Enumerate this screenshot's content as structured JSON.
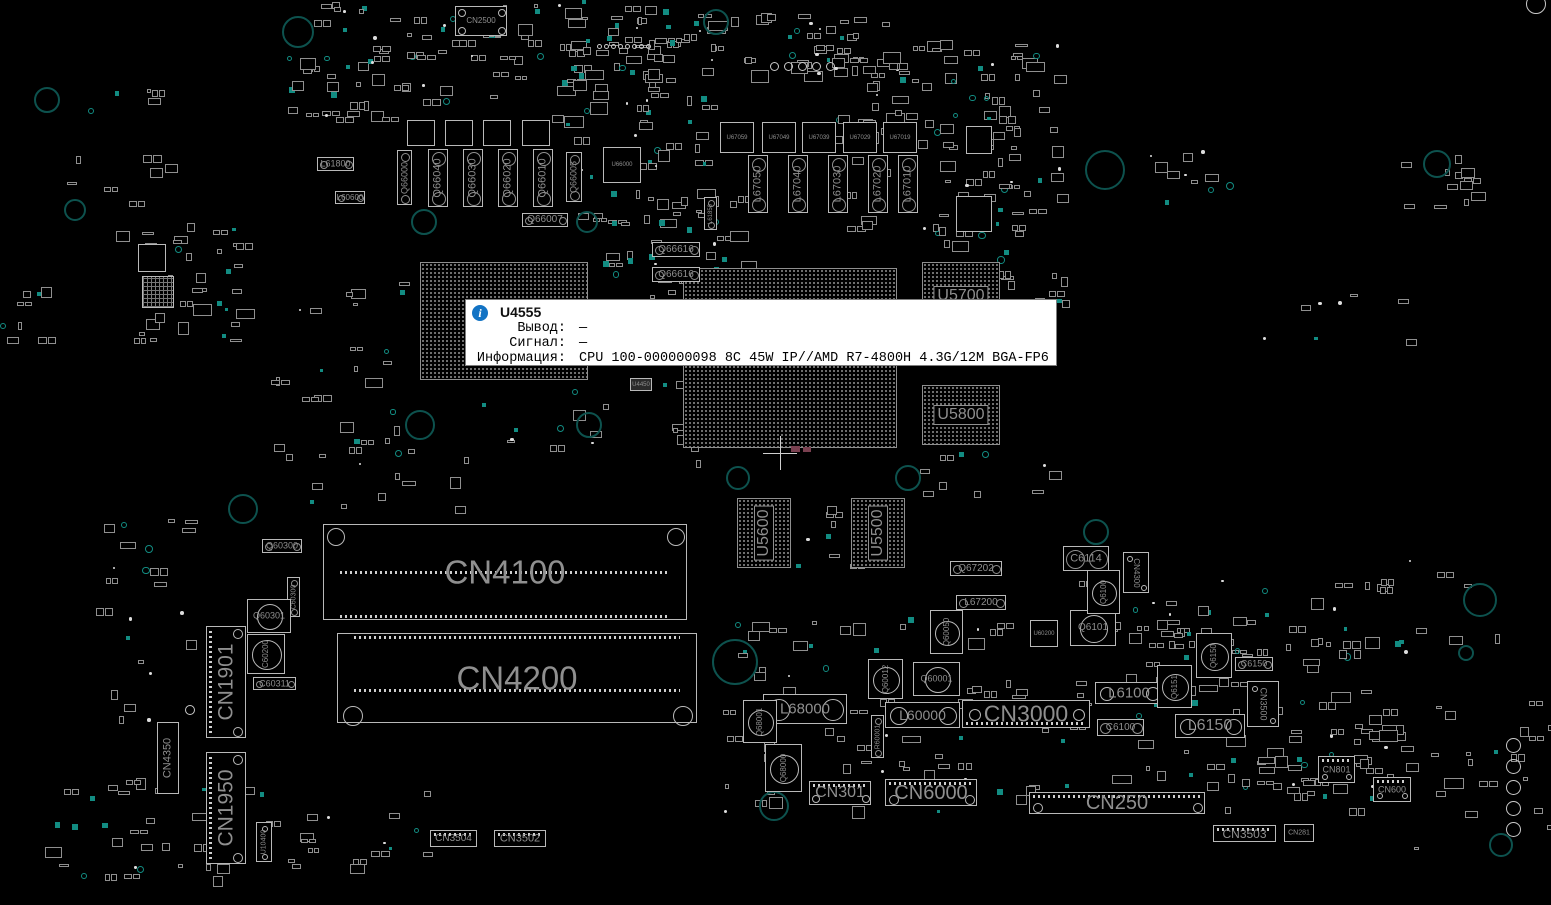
{
  "app": {
    "name": "boardview",
    "view": "top"
  },
  "colors": {
    "bg": "#000000",
    "outline": "#b9b9b9",
    "outline_dim": "#8f8f8f",
    "label": "#8f8f8f",
    "teal": "#128c82",
    "teal_ring": "#0d524e",
    "tooltip_bg": "#ffffff",
    "tooltip_text": "#000000",
    "info_blue": "#1273c4",
    "pink": "#7a4050"
  },
  "tooltip": {
    "ref": "U4555",
    "icon_glyph": "i",
    "x": 465,
    "y": 299,
    "w": 592,
    "h": 67,
    "rows": [
      {
        "label": "Вывод:",
        "value": "—"
      },
      {
        "label": "Сигнал:",
        "value": "—"
      },
      {
        "label": "Информация:",
        "value": "CPU 100-000000098 8C 45W IP//AMD R7-4800H 4.3G/12M BGA-FP6"
      }
    ]
  },
  "components": {
    "bgas": [
      {
        "ref": "",
        "x": 420,
        "y": 262,
        "w": 168,
        "h": 118,
        "fs": 0,
        "rot": 0
      },
      {
        "ref": "",
        "x": 683,
        "y": 268,
        "w": 214,
        "h": 180,
        "fs": 0,
        "rot": 0
      },
      {
        "ref": "U5700",
        "x": 922,
        "y": 262,
        "w": 78,
        "h": 68,
        "fs": 16,
        "rot": 0
      },
      {
        "ref": "U5800",
        "x": 922,
        "y": 385,
        "w": 78,
        "h": 60,
        "fs": 16,
        "rot": 0
      },
      {
        "ref": "U5600",
        "x": 737,
        "y": 498,
        "w": 54,
        "h": 70,
        "fs": 16,
        "rot": -90
      },
      {
        "ref": "U5500",
        "x": 851,
        "y": 498,
        "w": 54,
        "h": 70,
        "fs": 16,
        "rot": -90
      }
    ],
    "slots": [
      {
        "ref": "CN4100",
        "x": 323,
        "y": 524,
        "w": 364,
        "h": 96,
        "fs": 33,
        "circles": [
          [
            12,
            12,
            9
          ],
          [
            352,
            12,
            9
          ]
        ],
        "strips": [
          {
            "y": 46,
            "x0": 16,
            "x1": 348
          },
          {
            "y": 90,
            "x0": 16,
            "x1": 348
          }
        ]
      },
      {
        "ref": "CN4200",
        "x": 337,
        "y": 633,
        "w": 360,
        "h": 90,
        "fs": 33,
        "circles": [
          [
            15,
            82,
            10
          ],
          [
            345,
            82,
            10
          ]
        ],
        "strips": [
          {
            "y": 2,
            "x0": 16,
            "x1": 344
          },
          {
            "y": 55,
            "x0": 16,
            "x1": 344
          }
        ]
      }
    ],
    "hconn": [
      {
        "ref": "CN2500",
        "x": 455,
        "y": 6,
        "w": 52,
        "h": 30,
        "fs": 8,
        "pins": null,
        "circles": [
          [
            6,
            6,
            4
          ],
          [
            46,
            6,
            4
          ],
          [
            6,
            24,
            4
          ],
          [
            46,
            24,
            4
          ]
        ]
      },
      {
        "ref": "CN3000",
        "x": 962,
        "y": 700,
        "w": 128,
        "h": 28,
        "fs": 23,
        "pins": "bottom",
        "circles": [
          [
            12,
            14,
            6
          ],
          [
            116,
            14,
            6
          ]
        ]
      },
      {
        "ref": "CN6000",
        "x": 885,
        "y": 779,
        "w": 92,
        "h": 27,
        "fs": 20,
        "pins": "top",
        "circles": [
          [
            8,
            20,
            5
          ],
          [
            84,
            20,
            5
          ]
        ]
      },
      {
        "ref": "CN301",
        "x": 809,
        "y": 781,
        "w": 62,
        "h": 24,
        "fs": 16,
        "pins": "top",
        "circles": [
          [
            6,
            17,
            4
          ],
          [
            56,
            17,
            4
          ]
        ]
      },
      {
        "ref": "CN250",
        "x": 1029,
        "y": 792,
        "w": 176,
        "h": 22,
        "fs": 20,
        "pins": "top",
        "circles": [
          [
            8,
            15,
            5
          ],
          [
            168,
            15,
            5
          ]
        ]
      },
      {
        "ref": "CN3503",
        "x": 1213,
        "y": 825,
        "w": 63,
        "h": 17,
        "fs": 12,
        "pins": "top",
        "circles": []
      },
      {
        "ref": "CN281",
        "x": 1284,
        "y": 824,
        "w": 30,
        "h": 18,
        "fs": 7,
        "pins": null,
        "circles": []
      },
      {
        "ref": "CN801",
        "x": 1318,
        "y": 756,
        "w": 37,
        "h": 27,
        "fs": 9,
        "pins": "top",
        "circles": [
          [
            6,
            20,
            3
          ],
          [
            30,
            20,
            3
          ]
        ]
      },
      {
        "ref": "CN600",
        "x": 1373,
        "y": 777,
        "w": 38,
        "h": 25,
        "fs": 9,
        "pins": "top",
        "circles": [
          [
            6,
            18,
            3
          ],
          [
            31,
            18,
            3
          ]
        ]
      },
      {
        "ref": "CN3504",
        "x": 430,
        "y": 830,
        "w": 47,
        "h": 17,
        "fs": 10,
        "pins": "top",
        "circles": []
      },
      {
        "ref": "CN3502",
        "x": 494,
        "y": 830,
        "w": 52,
        "h": 17,
        "fs": 11,
        "pins": "top",
        "circles": []
      }
    ],
    "vconn": [
      {
        "ref": "CN1901",
        "x": 206,
        "y": 626,
        "w": 40,
        "h": 112,
        "fs": 21,
        "rot": -90,
        "pins": "left",
        "circles": [
          [
            31,
            7,
            5
          ],
          [
            31,
            105,
            5
          ]
        ]
      },
      {
        "ref": "CN1950",
        "x": 206,
        "y": 752,
        "w": 40,
        "h": 112,
        "fs": 21,
        "rot": -90,
        "pins": "left",
        "circles": [
          [
            31,
            7,
            5
          ],
          [
            31,
            105,
            5
          ]
        ]
      },
      {
        "ref": "CN4350",
        "x": 157,
        "y": 722,
        "w": 22,
        "h": 72,
        "fs": 11,
        "rot": -90,
        "pins": null,
        "circles": []
      },
      {
        "ref": "CN4300",
        "x": 1123,
        "y": 552,
        "w": 26,
        "h": 41,
        "fs": 8,
        "rot": 90,
        "pins": null,
        "circles": [
          [
            6,
            6,
            3
          ],
          [
            20,
            35,
            3
          ]
        ]
      },
      {
        "ref": "CN3500",
        "x": 1247,
        "y": 681,
        "w": 32,
        "h": 46,
        "fs": 9,
        "rot": 90,
        "pins": null,
        "circles": [
          [
            7,
            7,
            3
          ],
          [
            25,
            39,
            3
          ]
        ]
      },
      {
        "ref": "U10400",
        "x": 256,
        "y": 822,
        "w": 16,
        "h": 40,
        "fs": 7,
        "rot": -90,
        "pins": null,
        "circles": [
          [
            8,
            6,
            3
          ],
          [
            8,
            34,
            3
          ]
        ]
      }
    ],
    "tall": [
      {
        "ref": "Q66000",
        "x": 397,
        "y": 150,
        "w": 15,
        "h": 55,
        "fs": 9
      },
      {
        "ref": "Q66040",
        "x": 428,
        "y": 149,
        "w": 20,
        "h": 58,
        "fs": 11
      },
      {
        "ref": "Q66030",
        "x": 463,
        "y": 149,
        "w": 20,
        "h": 58,
        "fs": 11
      },
      {
        "ref": "Q66020",
        "x": 498,
        "y": 149,
        "w": 20,
        "h": 58,
        "fs": 11
      },
      {
        "ref": "Q66010",
        "x": 533,
        "y": 149,
        "w": 20,
        "h": 58,
        "fs": 11
      },
      {
        "ref": "Q66005",
        "x": 566,
        "y": 152,
        "w": 16,
        "h": 50,
        "fs": 9
      },
      {
        "ref": "L67050",
        "x": 748,
        "y": 155,
        "w": 20,
        "h": 58,
        "fs": 11
      },
      {
        "ref": "L67040",
        "x": 788,
        "y": 155,
        "w": 20,
        "h": 58,
        "fs": 11
      },
      {
        "ref": "L67030",
        "x": 828,
        "y": 155,
        "w": 20,
        "h": 58,
        "fs": 11
      },
      {
        "ref": "L67020",
        "x": 868,
        "y": 155,
        "w": 20,
        "h": 58,
        "fs": 11
      },
      {
        "ref": "L67010",
        "x": 898,
        "y": 155,
        "w": 20,
        "h": 58,
        "fs": 11
      },
      {
        "ref": "C60300",
        "x": 287,
        "y": 577,
        "w": 13,
        "h": 40,
        "fs": 7
      },
      {
        "ref": "R60001",
        "x": 871,
        "y": 715,
        "w": 13,
        "h": 43,
        "fs": 7
      },
      {
        "ref": "L61850",
        "x": 704,
        "y": 197,
        "w": 13,
        "h": 33,
        "fs": 6
      }
    ],
    "pills": [
      {
        "ref": "L61800",
        "x": 317,
        "y": 157,
        "w": 37,
        "h": 14,
        "fs": 9
      },
      {
        "ref": "L60600",
        "x": 335,
        "y": 191,
        "w": 30,
        "h": 13,
        "fs": 8
      },
      {
        "ref": "Q66007",
        "x": 522,
        "y": 213,
        "w": 46,
        "h": 14,
        "fs": 10
      },
      {
        "ref": "Q66616",
        "x": 652,
        "y": 242,
        "w": 48,
        "h": 15,
        "fs": 10
      },
      {
        "ref": "Q66616",
        "x": 652,
        "y": 267,
        "w": 48,
        "h": 15,
        "fs": 10
      },
      {
        "ref": "Q60300",
        "x": 262,
        "y": 539,
        "w": 40,
        "h": 14,
        "fs": 9
      },
      {
        "ref": "C60311",
        "x": 253,
        "y": 677,
        "w": 43,
        "h": 13,
        "fs": 9
      },
      {
        "ref": "Q67202",
        "x": 950,
        "y": 561,
        "w": 52,
        "h": 15,
        "fs": 10
      },
      {
        "ref": "L67200",
        "x": 956,
        "y": 595,
        "w": 50,
        "h": 15,
        "fs": 10
      },
      {
        "ref": "C6150",
        "x": 1235,
        "y": 657,
        "w": 38,
        "h": 14,
        "fs": 9
      },
      {
        "ref": "C6100",
        "x": 1097,
        "y": 719,
        "w": 47,
        "h": 17,
        "fs": 10
      },
      {
        "ref": "C6114",
        "x": 1063,
        "y": 546,
        "w": 46,
        "h": 25,
        "fs": 11
      }
    ],
    "chokes": [
      {
        "ref": "L68000",
        "x": 763,
        "y": 694,
        "w": 84,
        "h": 30,
        "fs": 15
      },
      {
        "ref": "L60000",
        "x": 885,
        "y": 702,
        "w": 75,
        "h": 26,
        "fs": 14
      },
      {
        "ref": "L6100",
        "x": 1095,
        "y": 682,
        "w": 68,
        "h": 22,
        "fs": 15
      },
      {
        "ref": "L6150",
        "x": 1175,
        "y": 714,
        "w": 70,
        "h": 24,
        "fs": 16
      }
    ],
    "fets": [
      {
        "ref": "Q60301",
        "x": 247,
        "y": 599,
        "w": 44,
        "h": 34,
        "fs": 9,
        "rot": 0
      },
      {
        "ref": "C60200",
        "x": 247,
        "y": 634,
        "w": 38,
        "h": 40,
        "fs": 8,
        "rot": -90
      },
      {
        "ref": "Q6101",
        "x": 1070,
        "y": 610,
        "w": 46,
        "h": 36,
        "fs": 10,
        "rot": 0
      },
      {
        "ref": "Q6100",
        "x": 1087,
        "y": 570,
        "w": 33,
        "h": 44,
        "fs": 8,
        "rot": -90
      },
      {
        "ref": "Q6150",
        "x": 1196,
        "y": 633,
        "w": 36,
        "h": 45,
        "fs": 8,
        "rot": -90
      },
      {
        "ref": "Q6151",
        "x": 1157,
        "y": 665,
        "w": 35,
        "h": 43,
        "fs": 8,
        "rot": -90
      },
      {
        "ref": "Q60050",
        "x": 930,
        "y": 610,
        "w": 33,
        "h": 44,
        "fs": 8,
        "rot": -90
      },
      {
        "ref": "Q60012",
        "x": 868,
        "y": 659,
        "w": 35,
        "h": 40,
        "fs": 8,
        "rot": -90
      },
      {
        "ref": "Q60001",
        "x": 913,
        "y": 662,
        "w": 47,
        "h": 34,
        "fs": 9,
        "rot": 0
      },
      {
        "ref": "Q68001",
        "x": 743,
        "y": 700,
        "w": 34,
        "h": 43,
        "fs": 8,
        "rot": -90
      },
      {
        "ref": "Q68000",
        "x": 765,
        "y": 744,
        "w": 37,
        "h": 48,
        "fs": 8,
        "rot": -90
      }
    ],
    "ics": [
      {
        "ref": "U66000",
        "x": 603,
        "y": 147,
        "w": 38,
        "h": 36,
        "fs": 6
      },
      {
        "ref": "U67059",
        "x": 720,
        "y": 122,
        "w": 34,
        "h": 31,
        "fs": 6
      },
      {
        "ref": "U67049",
        "x": 762,
        "y": 122,
        "w": 34,
        "h": 31,
        "fs": 6
      },
      {
        "ref": "U67039",
        "x": 802,
        "y": 122,
        "w": 34,
        "h": 31,
        "fs": 6
      },
      {
        "ref": "U67029",
        "x": 843,
        "y": 122,
        "w": 34,
        "h": 31,
        "fs": 6
      },
      {
        "ref": "U67019",
        "x": 883,
        "y": 122,
        "w": 34,
        "h": 31,
        "fs": 6
      },
      {
        "ref": "U60200",
        "x": 1030,
        "y": 620,
        "w": 28,
        "h": 27,
        "fs": 6
      },
      {
        "ref": "U4450",
        "x": 630,
        "y": 378,
        "w": 22,
        "h": 13,
        "fs": 6,
        "filled": true
      },
      {
        "ref": "",
        "x": 407,
        "y": 120,
        "w": 28,
        "h": 26,
        "fs": 6
      },
      {
        "ref": "",
        "x": 445,
        "y": 120,
        "w": 28,
        "h": 26,
        "fs": 6
      },
      {
        "ref": "",
        "x": 483,
        "y": 120,
        "w": 28,
        "h": 26,
        "fs": 6
      },
      {
        "ref": "",
        "x": 522,
        "y": 120,
        "w": 28,
        "h": 26,
        "fs": 6
      },
      {
        "ref": "",
        "x": 966,
        "y": 126,
        "w": 26,
        "h": 28,
        "fs": 6
      },
      {
        "ref": "",
        "x": 956,
        "y": 196,
        "w": 36,
        "h": 36,
        "fs": 6
      },
      {
        "ref": "",
        "x": 138,
        "y": 244,
        "w": 28,
        "h": 28,
        "fs": 6
      },
      {
        "ref": "",
        "x": 142,
        "y": 276,
        "w": 32,
        "h": 32,
        "fs": 6,
        "hatch": true
      }
    ]
  },
  "holes": [
    [
      298,
      32,
      16
    ],
    [
      716,
      22,
      13
    ],
    [
      47,
      100,
      13
    ],
    [
      75,
      210,
      11
    ],
    [
      424,
      222,
      13
    ],
    [
      587,
      222,
      11
    ],
    [
      1105,
      170,
      20
    ],
    [
      1437,
      164,
      14
    ],
    [
      420,
      425,
      15
    ],
    [
      589,
      425,
      13
    ],
    [
      243,
      509,
      15
    ],
    [
      738,
      478,
      12
    ],
    [
      908,
      478,
      13
    ],
    [
      1096,
      532,
      13
    ],
    [
      735,
      662,
      23
    ],
    [
      774,
      806,
      15
    ],
    [
      1480,
      600,
      17
    ],
    [
      1466,
      653,
      8
    ],
    [
      1501,
      845,
      12
    ]
  ],
  "wcircles": [
    [
      1536,
      4,
      10
    ],
    [
      190,
      710,
      5
    ]
  ],
  "dotrows": [
    {
      "x": 597,
      "y": 44,
      "n": 8,
      "step": 7,
      "d": 5,
      "vert": false
    },
    {
      "x": 770,
      "y": 62,
      "n": 5,
      "step": 14,
      "d": 9,
      "vert": false
    },
    {
      "x": 1506,
      "y": 738,
      "n": 5,
      "step": 21,
      "d": 15,
      "vert": true
    }
  ],
  "marks": {
    "cross": {
      "x": 780,
      "y": 453,
      "size": 34
    },
    "pink": [
      [
        791,
        446,
        9,
        6
      ],
      [
        803,
        447,
        8,
        5
      ]
    ]
  },
  "noise": {
    "seed": 42,
    "regions": [
      [
        285,
        0,
        420,
        118,
        120
      ],
      [
        560,
        38,
        150,
        185,
        52
      ],
      [
        592,
        0,
        125,
        62,
        20
      ],
      [
        700,
        0,
        185,
        72,
        36
      ],
      [
        828,
        28,
        185,
        205,
        80
      ],
      [
        935,
        38,
        125,
        215,
        52
      ],
      [
        125,
        222,
        112,
        118,
        38
      ],
      [
        55,
        88,
        125,
        145,
        15
      ],
      [
        268,
        282,
        135,
        175,
        26
      ],
      [
        598,
        188,
        145,
        108,
        36
      ],
      [
        655,
        378,
        100,
        95,
        22
      ],
      [
        300,
        438,
        180,
        68,
        13
      ],
      [
        478,
        388,
        125,
        60,
        11
      ],
      [
        718,
        612,
        645,
        198,
        160
      ],
      [
        1148,
        575,
        245,
        222,
        60
      ],
      [
        25,
        768,
        205,
        108,
        36
      ],
      [
        228,
        778,
        205,
        88,
        20
      ],
      [
        1378,
        552,
        172,
        315,
        30
      ],
      [
        1148,
        146,
        85,
        62,
        12
      ],
      [
        1392,
        148,
        85,
        62,
        12
      ],
      [
        0,
        282,
        42,
        85,
        8
      ],
      [
        95,
        515,
        92,
        235,
        24
      ],
      [
        978,
        238,
        85,
        75,
        14
      ],
      [
        1228,
        278,
        185,
        62,
        8
      ],
      [
        900,
        448,
        165,
        62,
        10
      ],
      [
        1290,
        725,
        120,
        80,
        22
      ],
      [
        1060,
        560,
        80,
        160,
        13
      ],
      [
        795,
        505,
        60,
        70,
        9
      ]
    ]
  }
}
